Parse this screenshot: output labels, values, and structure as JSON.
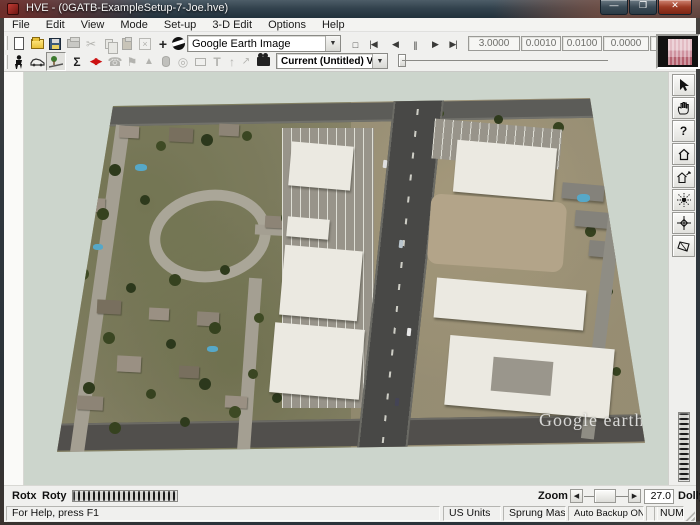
{
  "window": {
    "title": "HVE  -  (0GATB-ExampleSetup-7-Joe.hve)"
  },
  "menu": {
    "items": [
      "File",
      "Edit",
      "View",
      "Mode",
      "Set-up",
      "3-D Edit",
      "Options",
      "Help"
    ]
  },
  "toolbar": {
    "environment_combo": {
      "value": "Google Earth Image"
    },
    "view_combo": {
      "value": "Current (Untitled) View"
    },
    "fields": [
      "3.0000",
      "0.0010",
      "0.0100",
      "0.0000",
      "0"
    ],
    "glyphs": {
      "plus": "+",
      "scissors": "✂",
      "delete_x": "×",
      "stop": "□",
      "to_start": "|◀",
      "step_back": "◀",
      "pause": "||",
      "step_fwd": "▶",
      "to_end": "▶|",
      "sigma": "Σ",
      "diamond": "◀▶",
      "phone": "☎",
      "flag": "⚑",
      "cone": "▲",
      "torus": "◎",
      "text_tool": "T",
      "arrow_up": "↑",
      "arrow_ne": "↗",
      "combo_arrow": "▼",
      "question": "?"
    }
  },
  "viewport": {
    "watermark": "Google earth"
  },
  "controls": {
    "rotx_label": "Rotx",
    "roty_label": "Roty",
    "zoom_label": "Zoom",
    "zoom_value": "27.0",
    "dolly_label": "Dolly",
    "zoom_left_arrow": "◀",
    "zoom_right_arrow": "▶"
  },
  "statusbar": {
    "help": "For Help, press F1",
    "units": "US Units",
    "mass": "Sprung Mass",
    "backup": "Auto Backup ON",
    "num_lock": "NUM"
  },
  "colors": {
    "titlebar": "#33434e",
    "viewport_bg": "#ccd5cc",
    "accent_red": "#cc1111",
    "road": "#484846",
    "desert": "#b3a489",
    "roof_white": "#ebe9e1"
  }
}
